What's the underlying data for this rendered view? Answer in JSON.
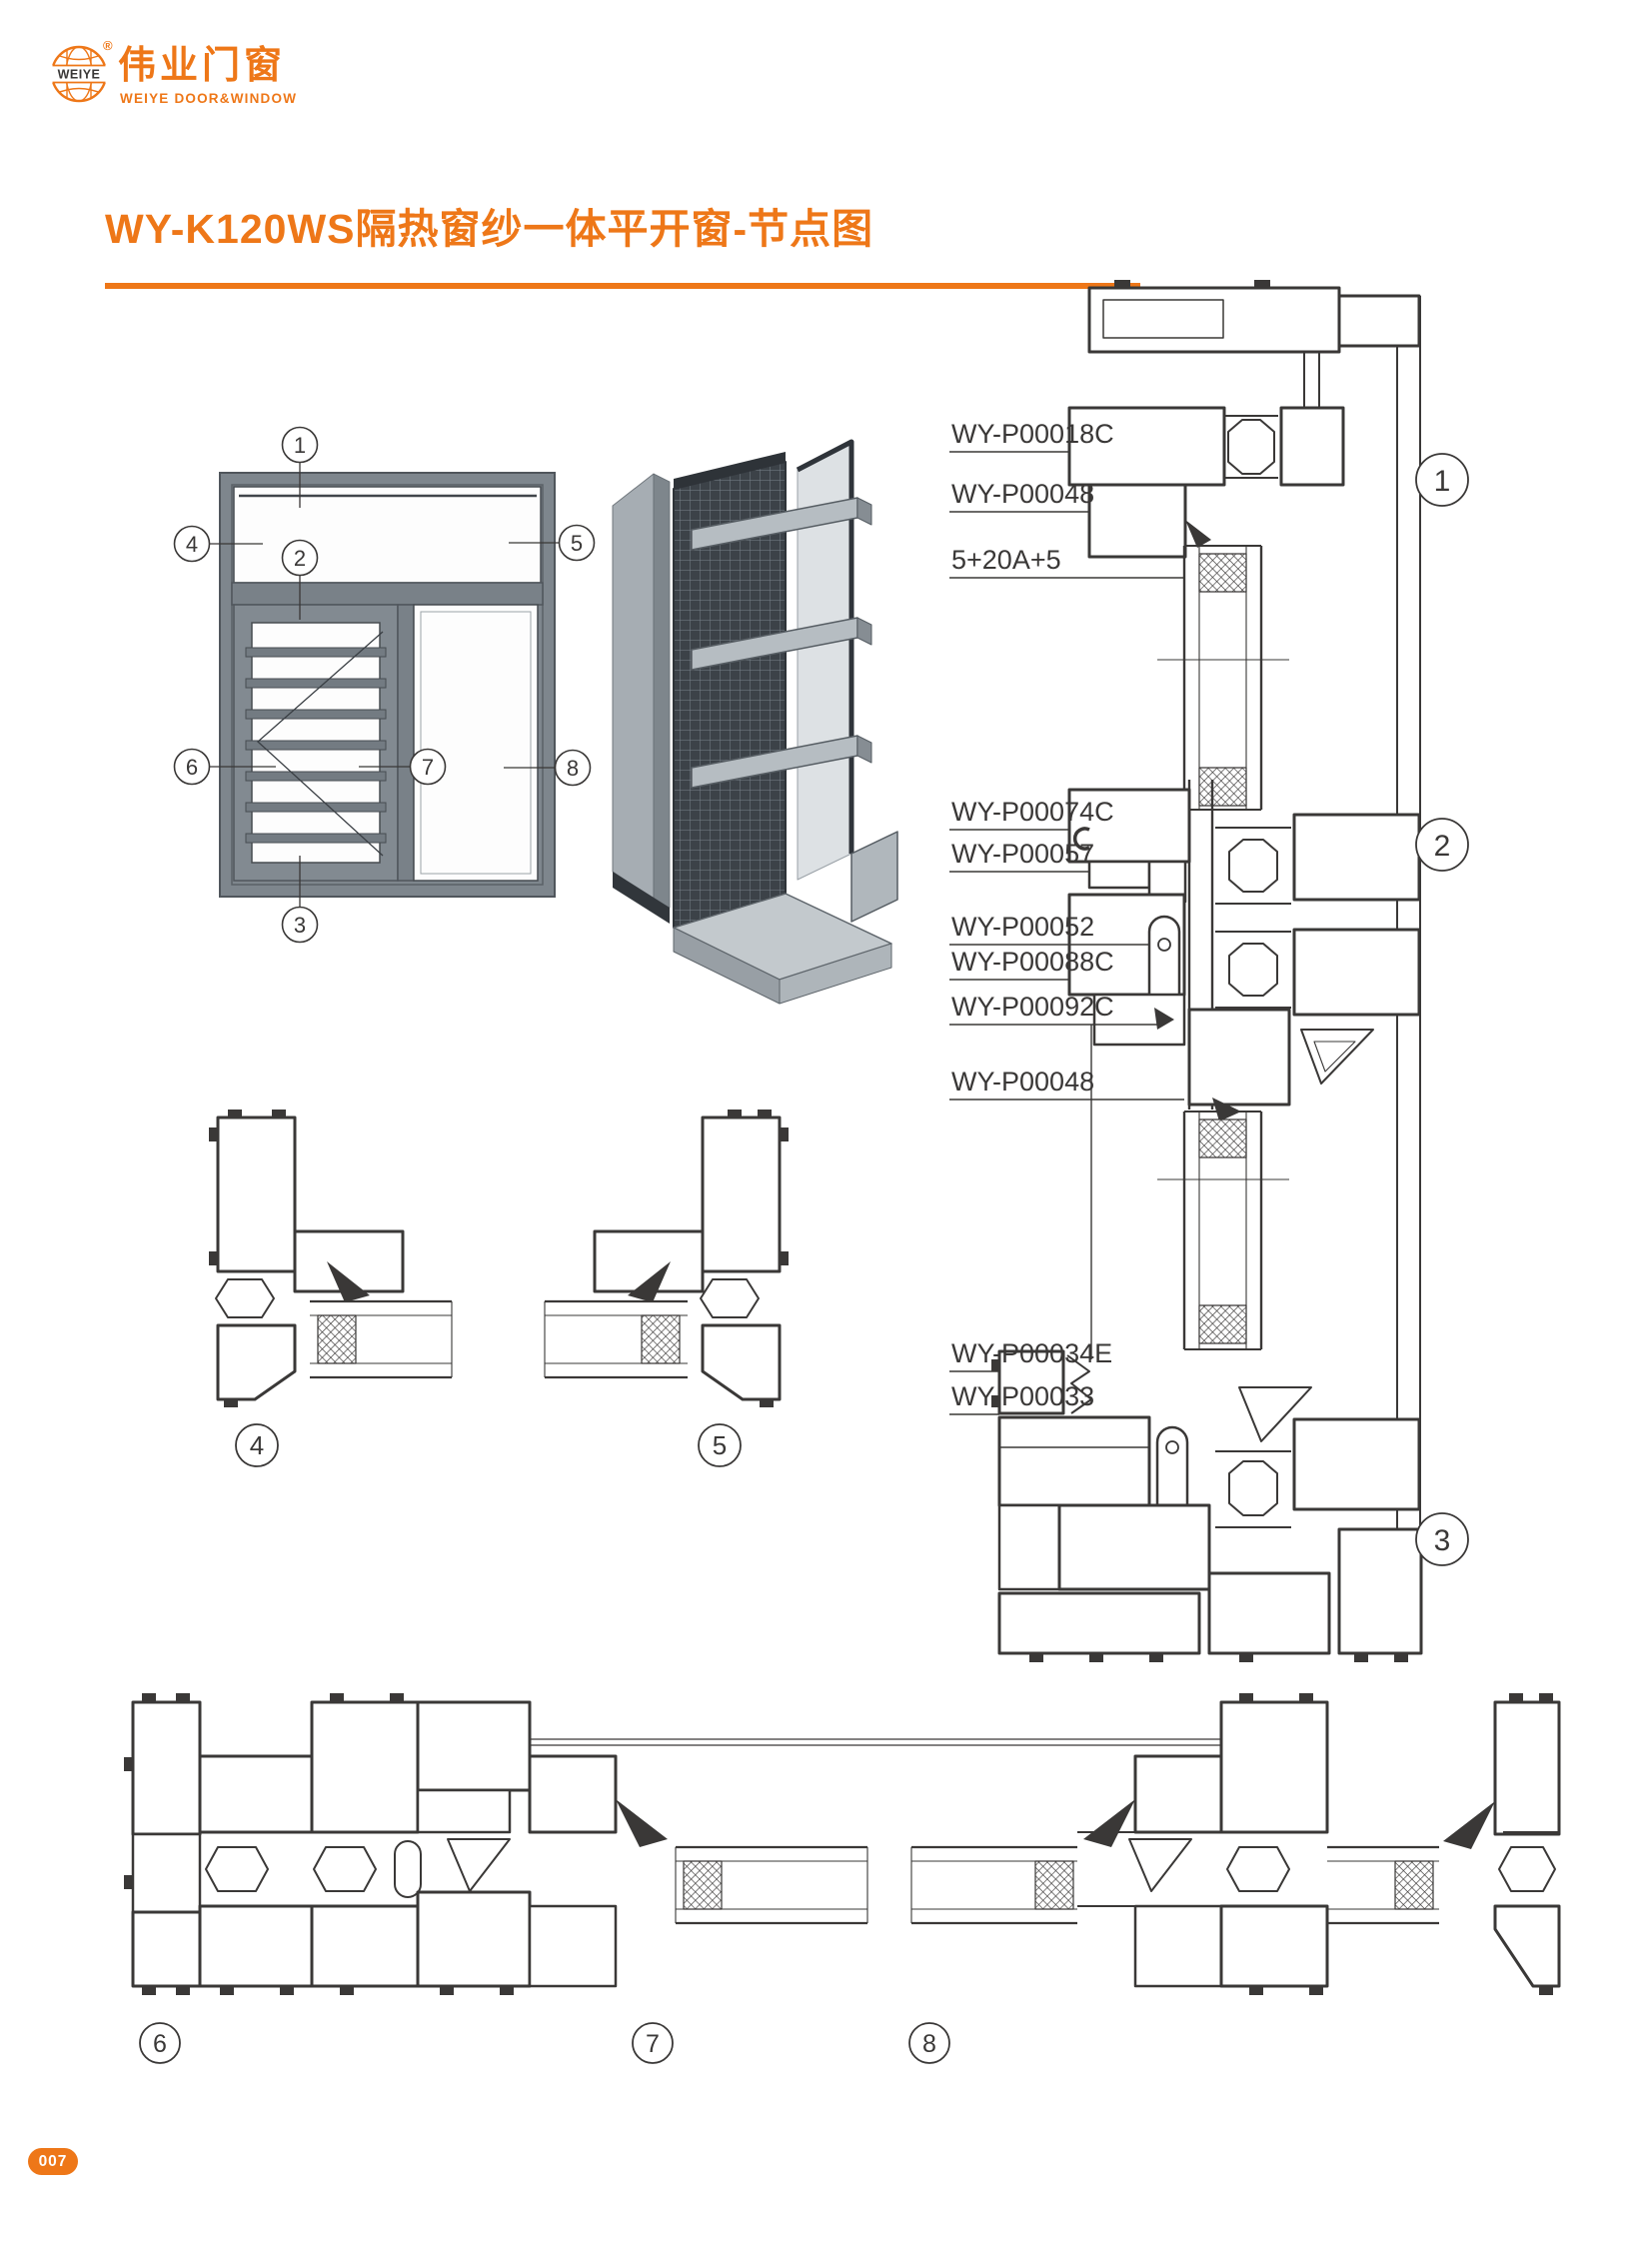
{
  "header": {
    "logo": {
      "globe_text": "WEIYE",
      "registered": "®",
      "brand_cn": "伟业门窗",
      "brand_en": "WEIYE DOOR&WINDOW"
    }
  },
  "title": {
    "text": "WY-K120WS隔热窗纱一体平开窗-节点图"
  },
  "colors": {
    "accent": "#EE7718",
    "line": "#3A3837",
    "frame_gray": "#7E868D"
  },
  "elevation": {
    "callouts": [
      "1",
      "2",
      "3",
      "4",
      "5",
      "6",
      "7",
      "8"
    ]
  },
  "section_vertical": {
    "labels": [
      "WY-P00018C",
      "WY-P00048",
      "5+20A+5",
      "WY-P00074C",
      "WY-P00057",
      "WY-P00052",
      "WY-P00088C",
      "WY-P00092C",
      "WY-P00048",
      "WY-P00034E",
      "WY-P00033"
    ],
    "callouts": [
      "1",
      "2",
      "3"
    ]
  },
  "section_details": {
    "callouts": [
      "4",
      "5"
    ]
  },
  "section_horizontal": {
    "callouts": [
      "6",
      "7",
      "8"
    ]
  },
  "footer": {
    "page_number": "007"
  }
}
